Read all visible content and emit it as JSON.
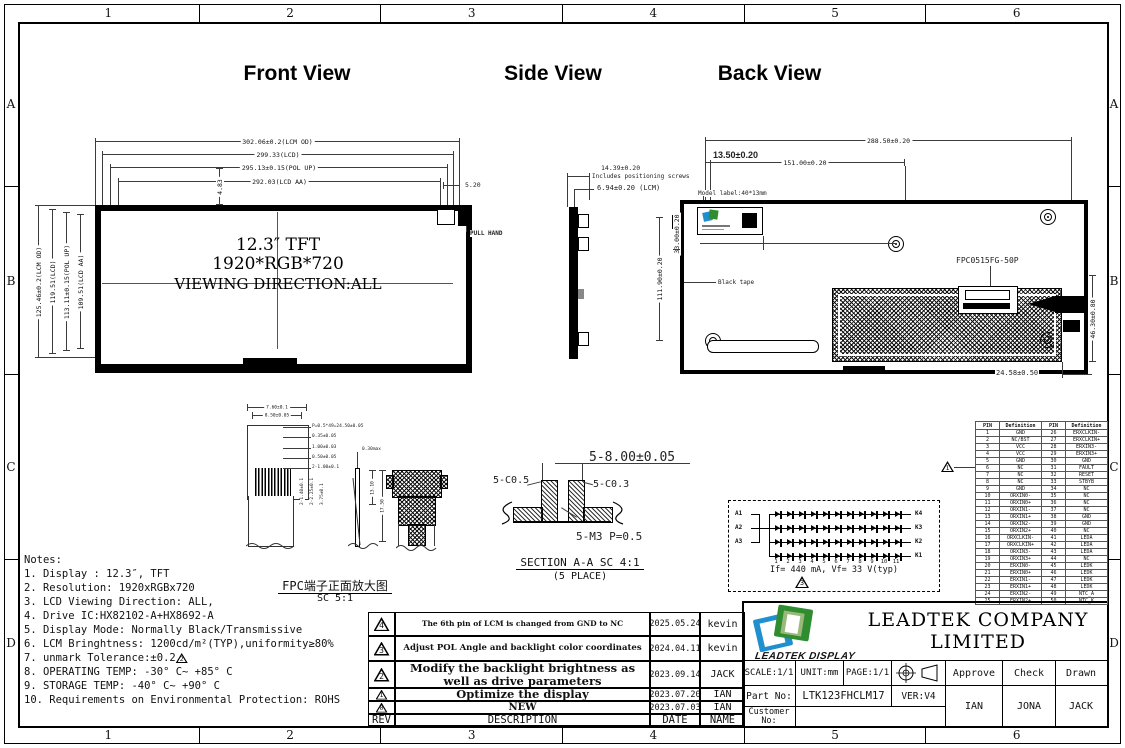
{
  "frame": {
    "columns": [
      "1",
      "2",
      "3",
      "4",
      "5",
      "6"
    ],
    "rows": [
      "A",
      "B",
      "C",
      "D"
    ]
  },
  "front_view": {
    "title": "Front View",
    "dims_top": [
      "302.06±0.2(LCM OD)",
      "299.33(LCD)",
      "295.13±0.15(POL UP)",
      "292.03(LCD AA)"
    ],
    "dim_5_20": "5.20",
    "dim_4_83": "4.83",
    "dims_left": [
      "125.46±0.2(LCM OD)",
      "119.51(LCD)",
      "113.11±0.15(POL UP)",
      "109.51(LCD AA)"
    ],
    "screen_line1": "12.3″ TFT",
    "screen_line2": "1920*RGB*720",
    "screen_line3": "VIEWING DIRECTION:ALL",
    "pull_hand_label": "PULL HAND"
  },
  "side_view": {
    "title": "Side View",
    "dim_total": "14.39±0.20",
    "dim_total_note": "Includes positioning screws",
    "dim_lcm": "6.94±0.20 (LCM)"
  },
  "back_view": {
    "title": "Back View",
    "dim_width": "288.50±0.20",
    "dim_mid": "151.00±0.20",
    "dim_offset": "13.50±0.20",
    "model_label_note": "Model label:40*13mm",
    "dim_height": "111.90±0.20",
    "dim_33": "33.00±0.20",
    "black_tape_label": "Black tape",
    "connector_label": "FPC0515FG-50P",
    "dim_46": "46.30±0.80",
    "dim_24": "24.58±0.50"
  },
  "fpc_detail": {
    "caption": "FPC端子正面放大图",
    "scale": "SC 5:1",
    "dims": [
      "7.60±0.1",
      "8.50±0.05",
      "P=0.5*49=24.50±0.05",
      "0.35±0.05",
      "1.00±0.03",
      "0.50±0.05",
      "2-1.00±0.1",
      "2-1.40±0.1",
      "2-2.25±0.1",
      "3.75±0.1",
      "0.30max",
      "13.10",
      "17.50"
    ]
  },
  "section_view": {
    "dim_8": "5-8.00±0.05",
    "dim_c05": "5-C0.5",
    "dim_c03": "5-C0.3",
    "dim_m3": "5-M3 P=0.5",
    "caption": "SECTION A-A SC 4:1",
    "caption2": "(5 PLACE)"
  },
  "led_diagram": {
    "anode_labels": [
      "A1",
      "A2",
      "A3"
    ],
    "cathode_labels": [
      "K4",
      "K3",
      "K2",
      "K1"
    ],
    "leds_per_string": 11,
    "index_labels": [
      "1",
      "2",
      "3",
      "4",
      "5",
      "6",
      "7",
      "8",
      "9",
      "10",
      "11"
    ],
    "spec": "If= 440 mA, Vf= 33 V(typ)",
    "rev_marker": "3"
  },
  "pin_table": {
    "headers": [
      "PIN",
      "Definition",
      "PIN",
      "Definition"
    ],
    "rev_marker": "1",
    "rows": [
      [
        "1",
        "GND",
        "26",
        "ERXCLKIN-"
      ],
      [
        "2",
        "NC/BST",
        "27",
        "ERXCLKIN+"
      ],
      [
        "3",
        "VCC",
        "28",
        "ERXIN3-"
      ],
      [
        "4",
        "VCC",
        "29",
        "ERXIN3+"
      ],
      [
        "5",
        "GND",
        "30",
        "GND"
      ],
      [
        "6",
        "NC",
        "31",
        "FAULT"
      ],
      [
        "7",
        "NC",
        "32",
        "RESET"
      ],
      [
        "8",
        "NC",
        "33",
        "STBYB"
      ],
      [
        "9",
        "GND",
        "34",
        "NC"
      ],
      [
        "10",
        "ORXIN0-",
        "35",
        "NC"
      ],
      [
        "11",
        "ORXIN0+",
        "36",
        "NC"
      ],
      [
        "12",
        "ORXIN1-",
        "37",
        "NC"
      ],
      [
        "13",
        "ORXIN1+",
        "38",
        "GND"
      ],
      [
        "14",
        "ORXIN2-",
        "39",
        "GND"
      ],
      [
        "15",
        "ORXIN2+",
        "40",
        "NC"
      ],
      [
        "16",
        "ORXCLKIN-",
        "41",
        "LEDA"
      ],
      [
        "17",
        "ORXCLKIN+",
        "42",
        "LEDA"
      ],
      [
        "18",
        "ORXIN3-",
        "43",
        "LEDA"
      ],
      [
        "19",
        "ORXIN3+",
        "44",
        "NC"
      ],
      [
        "20",
        "ERXIN0-",
        "45",
        "LEDK"
      ],
      [
        "21",
        "ERXIN0+",
        "46",
        "LEDK"
      ],
      [
        "22",
        "ERXIN1-",
        "47",
        "LEDK"
      ],
      [
        "23",
        "ERXIN1+",
        "48",
        "LEDK"
      ],
      [
        "24",
        "ERXIN2-",
        "49",
        "NTC_A"
      ],
      [
        "25",
        "ERXIN2+",
        "50",
        "NTC_K"
      ]
    ]
  },
  "notes": {
    "title": "Notes:",
    "items": [
      {
        "text": "1. Display : 12.3″,  TFT"
      },
      {
        "text": "2. Resolution: 1920xRGBx720"
      },
      {
        "text": "3. LCD Viewing Direction: ALL,"
      },
      {
        "text": "4. Drive IC:HX82102-A+HX8692-A"
      },
      {
        "text": "5. Display Mode: Normally Black/Transmissive"
      },
      {
        "text": "6. LCM Bringhtness: 1200cd/m²(TYP),uniformity≥80%"
      },
      {
        "text": "7. unmark Tolerance:±0.2",
        "marker": "2"
      },
      {
        "text": "8. OPERATING TEMP: -30° C~ +85° C"
      },
      {
        "text": "9. STORAGE TEMP: -40° C~ +90° C"
      },
      {
        "text": "10. Requirements on Environmental Protection: ROHS"
      }
    ]
  },
  "revision_table": {
    "headers": {
      "rev": "REV",
      "description": "DESCRIPTION",
      "date": "DATE",
      "name": "NAME"
    },
    "rows": [
      {
        "rev": "4",
        "description": "The 6th pin of LCM is changed from GND to NC",
        "date": "2025.05.24",
        "name": "kevin"
      },
      {
        "rev": "3",
        "description": "Adjust POL Angle and backlight color coordinates",
        "date": "2024.04.11",
        "name": "kevin"
      },
      {
        "rev": "2",
        "description": "Modify the backlight brightness as\nwell as drive parameters",
        "date": "2023.09.14",
        "name": "JACK"
      },
      {
        "rev": "1",
        "description": "Optimize the display",
        "date": "2023.07.20",
        "name": "IAN"
      },
      {
        "rev": "0",
        "description": "NEW",
        "date": "2023.07.03",
        "name": "IAN"
      }
    ]
  },
  "title_block": {
    "company": "LEADTEK COMPANY LIMITED",
    "logo_caption": "LEADTEK DISPLAY",
    "scale": "SCALE:1/1",
    "unit": "UNIT:mm",
    "page": "PAGE:1/1",
    "approve_label": "Approve",
    "check_label": "Check",
    "drawn_label": "Drawn",
    "part_no_label": "Part No:",
    "part_no": "LTK123FHCLM17",
    "version": "VER:V4",
    "customer_no_label": "Customer No:",
    "approve_name": "IAN",
    "check_name": "JONA",
    "drawn_name": "JACK"
  },
  "colors": {
    "line": "#000000",
    "logo_blue": "#1f8fd0",
    "logo_green": "#2f8c2f",
    "logo_light_green": "#9bb87b"
  }
}
